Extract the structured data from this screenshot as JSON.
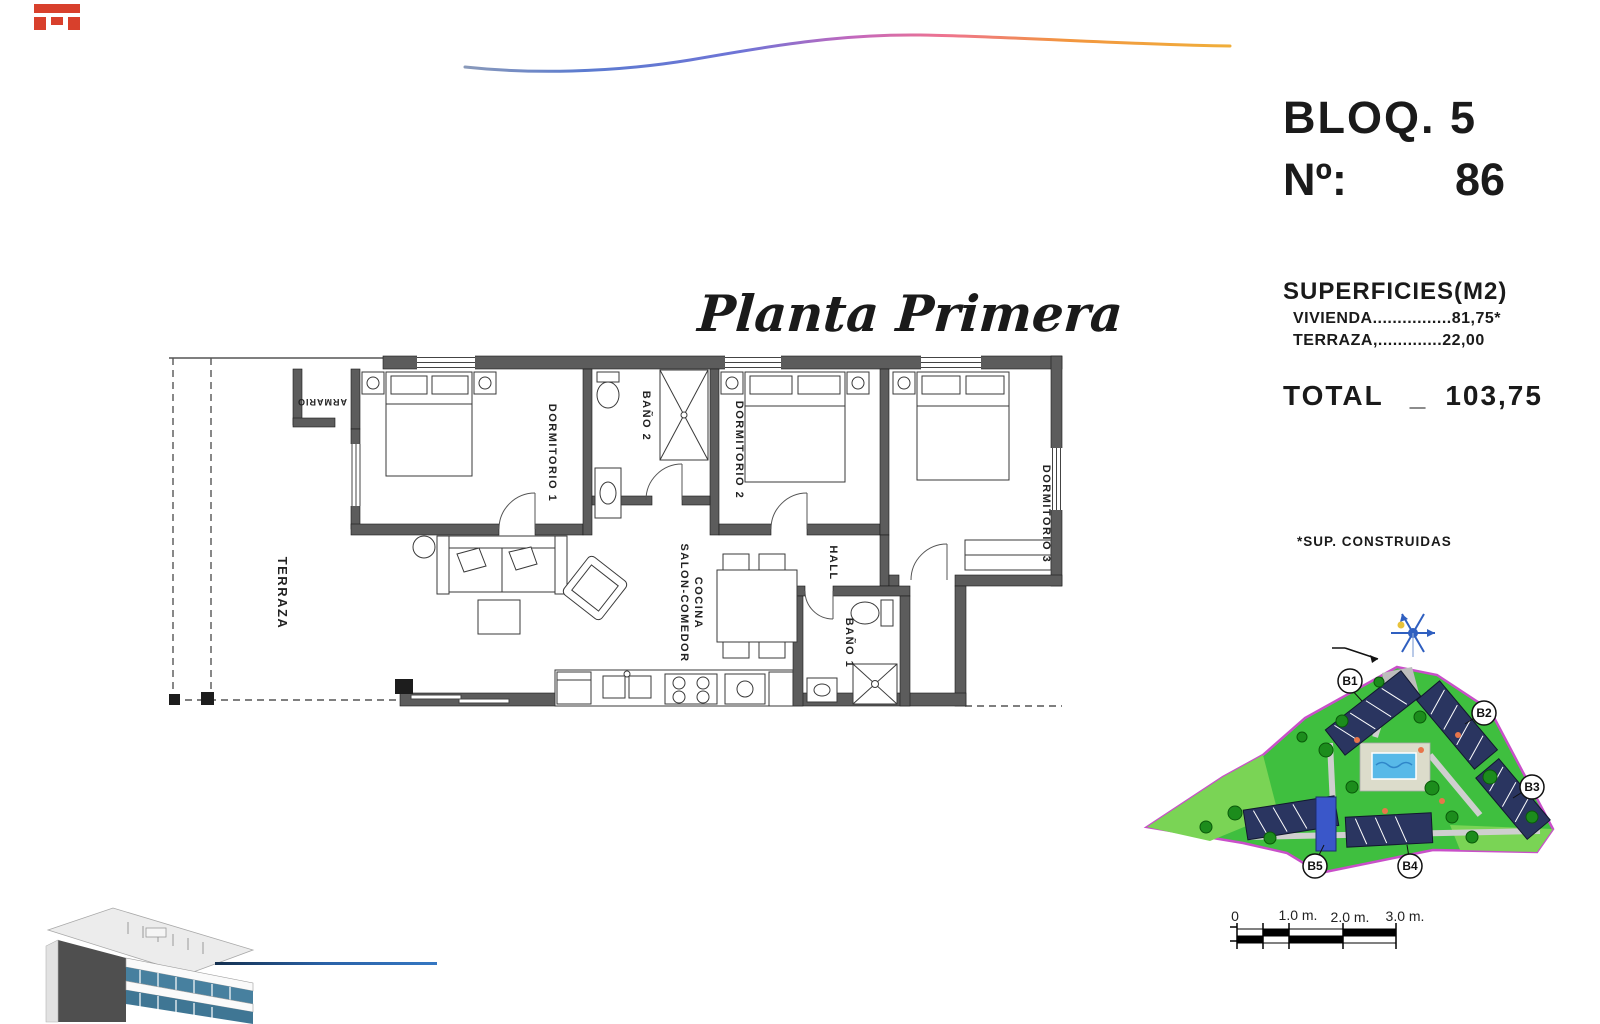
{
  "brand": {
    "logo_color": "#d8402c"
  },
  "swoosh": {
    "gradient": [
      "#93a0b5",
      "#5b7bd0",
      "#6f74d6",
      "#c468bc",
      "#ee7390",
      "#f2953f",
      "#f0b03a"
    ]
  },
  "unit": {
    "block_label": "BLOQ. 5",
    "number_label": "Nº:",
    "number_value": "86"
  },
  "surfaces": {
    "title": "SUPERFICIES(M2)",
    "rows": [
      {
        "label": "VIVIENDA",
        "dots": "................",
        "value": "81,75*"
      },
      {
        "label": "TERRAZA,",
        "dots": ".............",
        "value": "22,00"
      }
    ],
    "total": {
      "label": "TOTAL",
      "separator": "_",
      "value": "103,75"
    },
    "footnote": "*SUP. CONSTRUIDAS"
  },
  "plan": {
    "title": "Planta Primera",
    "rooms": {
      "terraza": "TERRAZA",
      "armario": "ARMARIO",
      "dormitorio1": "DORMITORIO 1",
      "bano2": "BAÑO 2",
      "dormitorio2": "DORMITORIO 2",
      "dormitorio3": "DORMITORIO 3",
      "hall": "HALL",
      "salon_line1": "SALON-COMEDOR",
      "salon_line2": "COCINA",
      "bano1": "BAÑO 1"
    }
  },
  "site": {
    "blocks": [
      "B1",
      "B2",
      "B3",
      "B4",
      "B5"
    ],
    "colors": {
      "grass": "#3fbf3f",
      "grass_light": "#7ad455",
      "boundary": "#c94fc9",
      "building": "#2a3560",
      "pool": "#58b9e8",
      "tree": "#1c8c1c"
    }
  },
  "scale_bar": {
    "ticks": [
      "0",
      "1.0 m.",
      "2.0 m.",
      "3.0 m."
    ]
  }
}
